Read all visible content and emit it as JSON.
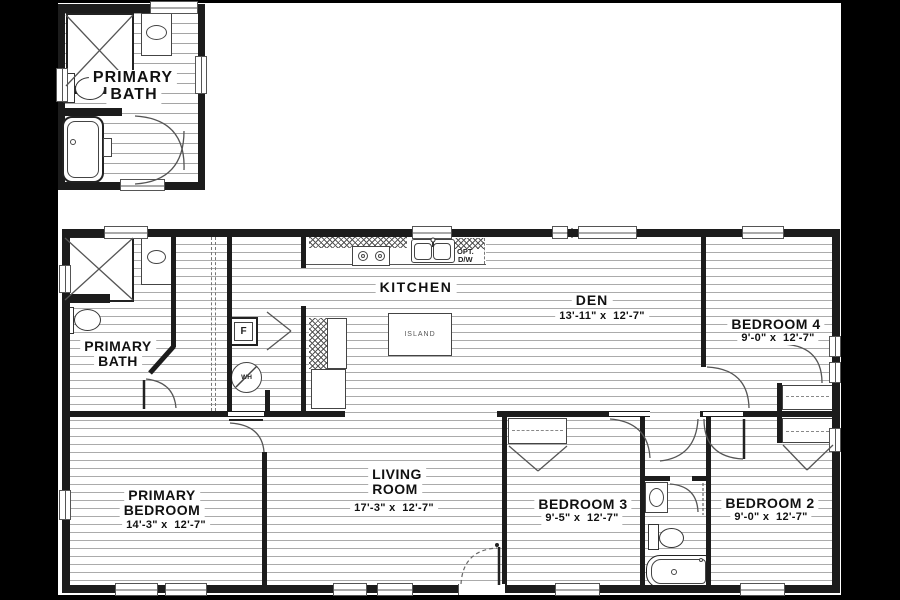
{
  "colors": {
    "canvas_bg": "#000000",
    "paper": "#ffffff",
    "wall": "#1c1c1c",
    "hatch_line": "#ababab",
    "text": "#111111"
  },
  "inset_bath": {
    "label_line1": "PRIMARY",
    "label_line2": "BATH"
  },
  "rooms": {
    "primary_bath": {
      "label_line1": "PRIMARY",
      "label_line2": "BATH"
    },
    "kitchen": {
      "label": "KITCHEN"
    },
    "den": {
      "label": "DEN",
      "dims": "13'-11\" x  12'-7\""
    },
    "bedroom_4": {
      "label": "BEDROOM 4",
      "dims": "9'-0\" x  12'-7\""
    },
    "primary_bedroom": {
      "label_line1": "PRIMARY",
      "label_line2": "BEDROOM",
      "dims": "14'-3\" x  12'-7\""
    },
    "living_room": {
      "label_line1": "LIVING",
      "label_line2": "ROOM",
      "dims": "17'-3\" x  12'-7\""
    },
    "bedroom_3": {
      "label": "BEDROOM 3",
      "dims": "9'-5\" x  12'-7\""
    },
    "bedroom_2": {
      "label": "BEDROOM 2",
      "dims": "9'-0\" x  12'-7\""
    }
  },
  "fixtures": {
    "island_label": "ISLAND",
    "opt_dw_line1": "OPT.",
    "opt_dw_line2": "D/W",
    "furnace_label": "F",
    "water_heater_label": "WH"
  }
}
